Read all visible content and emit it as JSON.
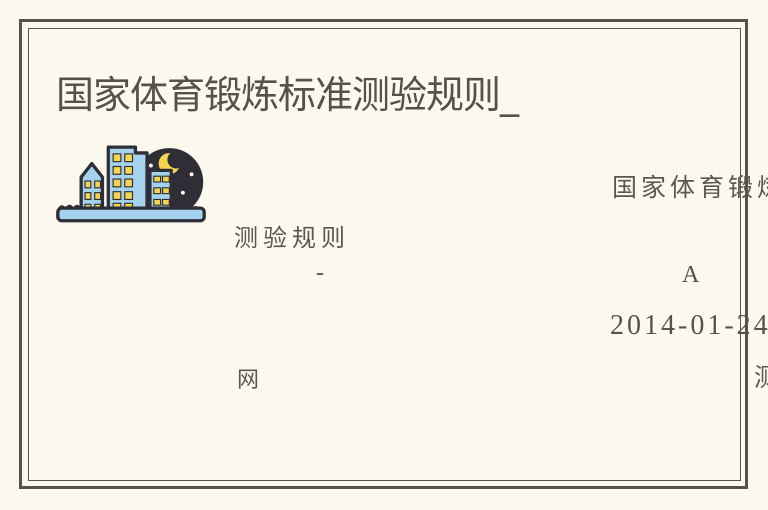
{
  "colors": {
    "background": "#fbf9ee",
    "frame": "#57534b",
    "title_ink": "#56514a",
    "hand_ink": "#5c574f",
    "serif_ink": "#57524b",
    "logo_dark": "#2f2e37",
    "logo_blue": "#a5d2ec",
    "logo_yellow": "#f5d54f",
    "logo_star": "#fffdf4"
  },
  "header": {
    "title": "国家体育锻炼标准测验规则_"
  },
  "logo": {
    "name": "night-city-logo"
  },
  "page_texts": {
    "source_fragment": "国家体育锻炼",
    "subtitle_fragment": "测验规则",
    "dash": "-",
    "grade": "A",
    "date": "2014-01-24",
    "site_suffix": "网",
    "edge_clipped_fragment": "测"
  }
}
